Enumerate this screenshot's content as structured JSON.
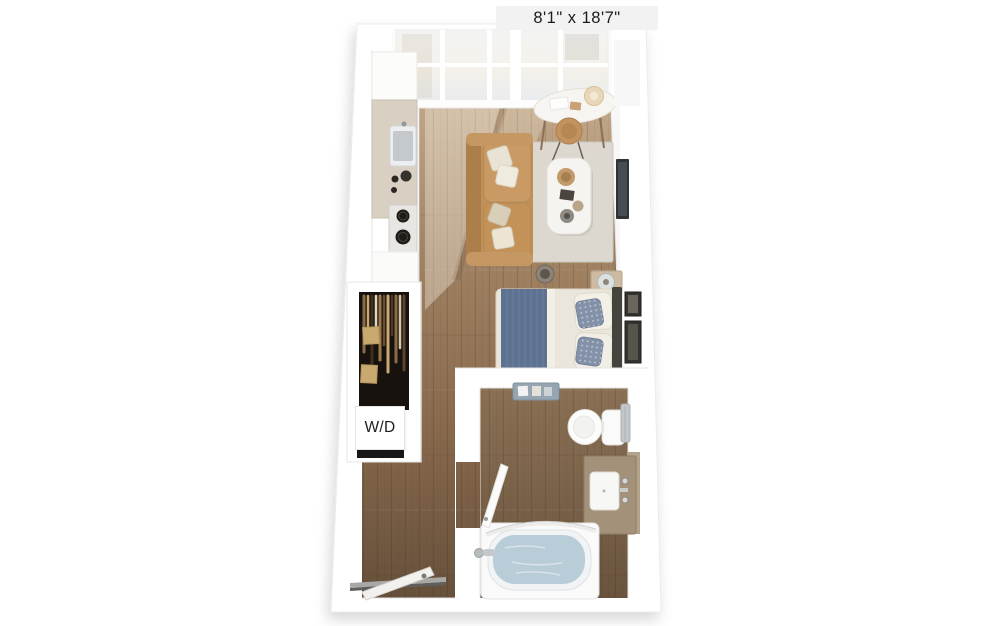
{
  "page": {
    "background": "#ffffff"
  },
  "floor_plan": {
    "dimension_label": "8'1\" x 18'7\"",
    "washer_dryer_label": "W/D"
  },
  "colors": {
    "label_background": "#f2f2f2",
    "label_text": "#1c1c1c",
    "wall": "#ffffff",
    "floor_wood_light": "#c0a687",
    "floor_wood_dark": "#66503b",
    "bathroom_floor": "#77604a",
    "rug": "#dcd8d0",
    "sofa": "#bf9057",
    "kitchen_counter": "#d9cfc2",
    "bed_duvet": "#ebe6dc",
    "bed_throw": "#5d7191",
    "accent_pillow": "#8492a9",
    "headboard": "#45433e",
    "closet_interior": "#17120d",
    "vanity": "#a39179",
    "bath_water": "#b9cdd9",
    "tv": "#2f3337"
  }
}
